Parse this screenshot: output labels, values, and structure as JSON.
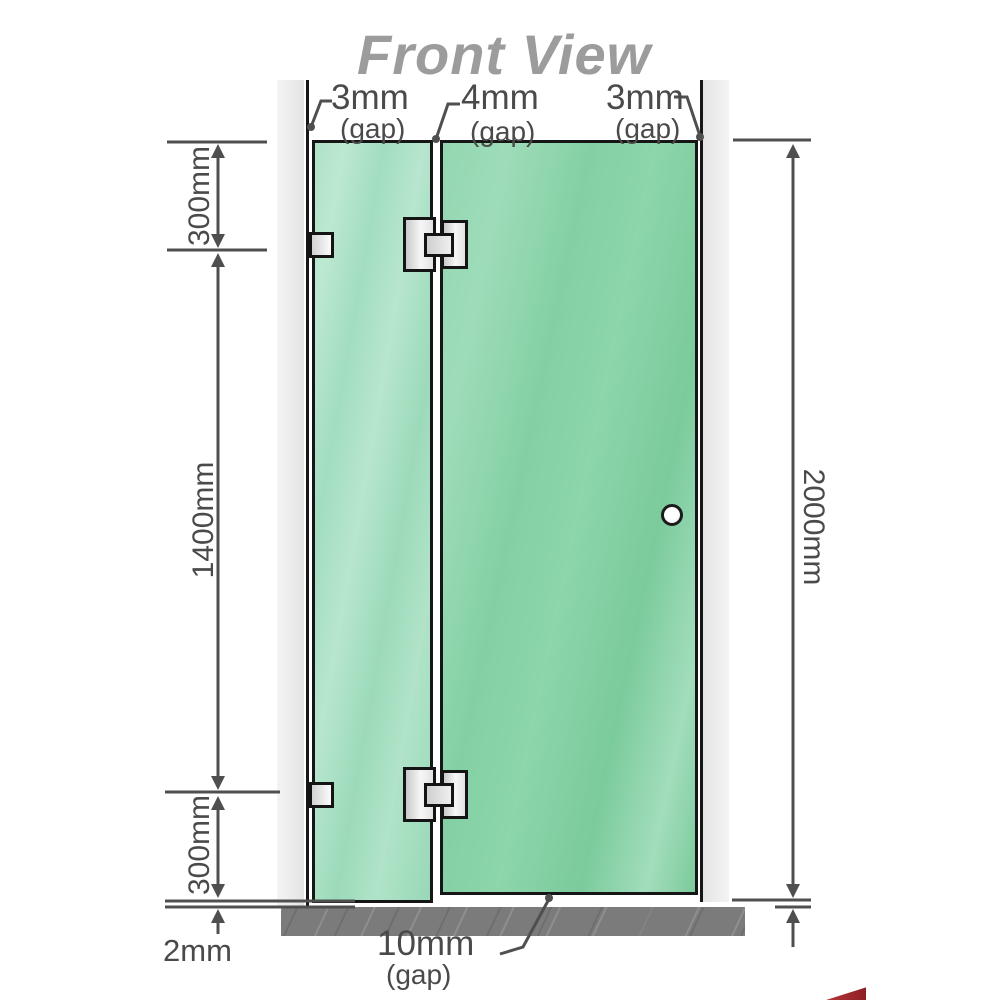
{
  "title": "Front View",
  "labels": {
    "top_left_gap": {
      "value": "3mm",
      "suffix": "(gap)"
    },
    "top_mid_gap": {
      "value": "4mm",
      "suffix": "(gap)"
    },
    "top_right_gap": {
      "value": "3mm",
      "suffix": "(gap)"
    },
    "bottom_gap": {
      "value": "10mm",
      "suffix": "(gap)"
    },
    "left_top_height": "300mm",
    "left_middle_height": "1400mm",
    "left_bottom_height": "300mm",
    "floor_gap": "2mm",
    "total_height": "2000mm"
  },
  "colors": {
    "glass_green": "#8dd5ab",
    "wall_gray": "#e9e9e9",
    "floor_gray": "#7b7b7b",
    "dimension_gray": "#4a4a4a",
    "title_gray": "#9c9c9c",
    "logo_red": "#a8242a"
  }
}
